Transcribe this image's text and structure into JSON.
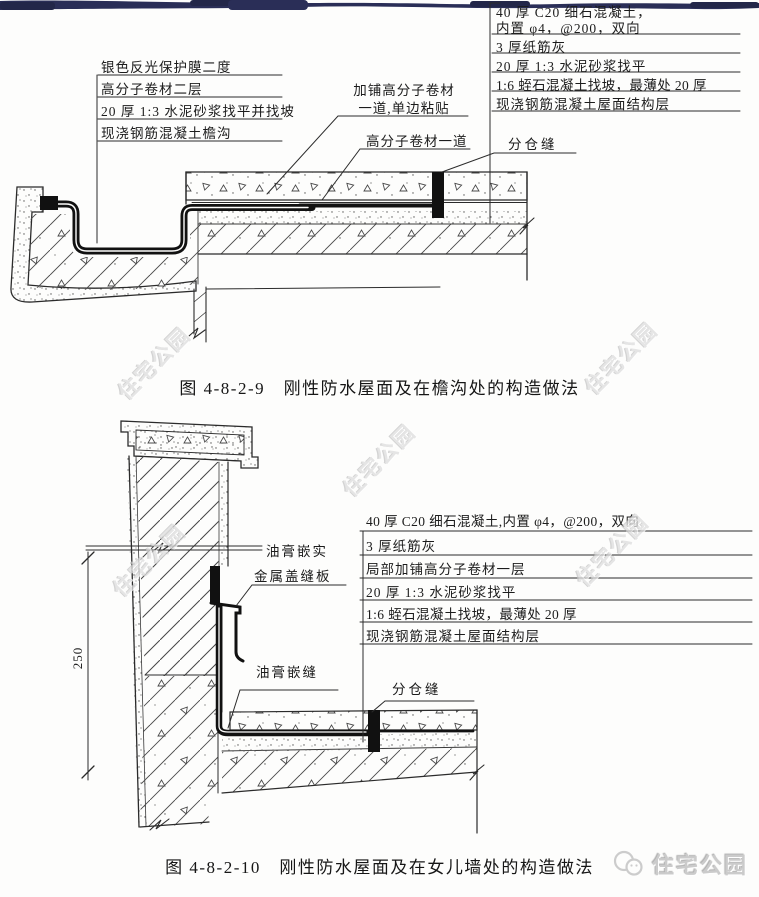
{
  "watermark": "住宅公园",
  "brand": "住宅公园",
  "fig1": {
    "caption": "图 4-8-2-9　刚性防水屋面及在檐沟处的构造做法",
    "left_labels": [
      "银色反光保护膜二度",
      "高分子卷材二层",
      "20 厚 1:3 水泥砂浆找平并找坡",
      "现浇钢筋混凝土檐沟"
    ],
    "overlay_label_line1": "加铺高分子卷材",
    "overlay_label_line2": "一道,单边粘贴",
    "membrane_label": "高分子卷材一道",
    "joint_label": "分仓缝",
    "right_labels": [
      "40 厚 C20 细石混凝土，",
      "内置 φ4，@200，双向",
      "3 厚纸筋灰",
      "20 厚 1:3 水泥砂浆找平",
      "1:6 蛭石混凝土找坡，最薄处 20 厚",
      "现浇钢筋混凝土屋面结构层"
    ]
  },
  "fig2": {
    "caption": "图 4-8-2-10　刚性防水屋面及在女儿墙处的构造做法",
    "right_labels": [
      "40 厚 C20 细石混凝土,内置 φ4，@200，双向",
      "3 厚纸筋灰",
      "局部加铺高分子卷材一层",
      "20 厚 1:3 水泥砂浆找平",
      "1:6 蛭石混凝土找坡，最薄处 20 厚",
      "现浇钢筋混凝土屋面结构层"
    ],
    "sealant_top_label": "油膏嵌实",
    "cover_plate_label": "金属盖缝板",
    "sealant_joint_label": "油膏嵌缝",
    "joint_label": "分仓缝",
    "dimension": "250"
  }
}
